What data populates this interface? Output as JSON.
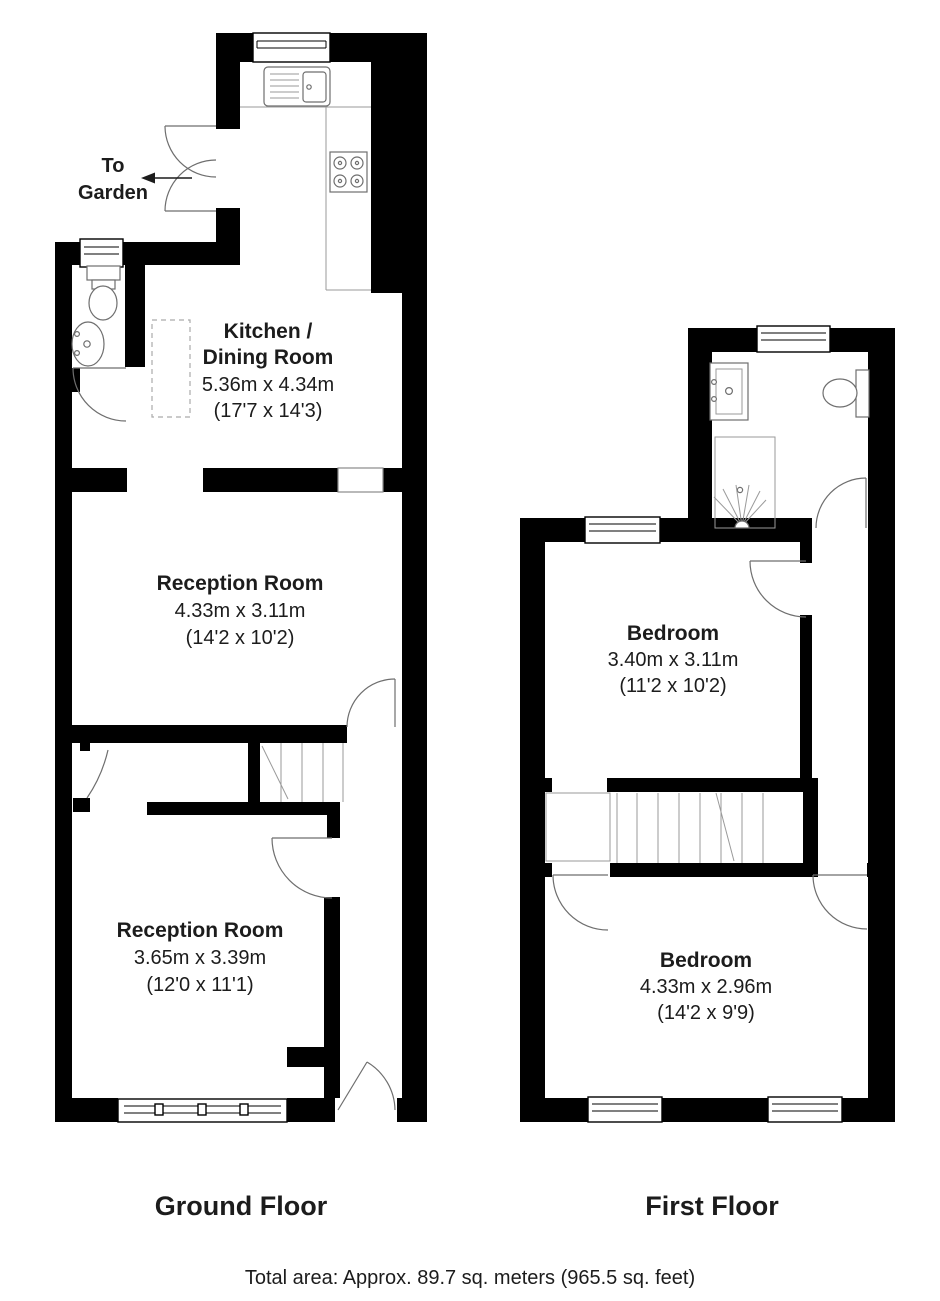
{
  "plan": {
    "ground_floor": {
      "title": "Ground Floor",
      "garden": {
        "line1": "To",
        "line2": "Garden"
      },
      "kitchen": {
        "name1": "Kitchen /",
        "name2": "Dining Room",
        "metric": "5.36m x 4.34m",
        "imperial": "(17'7 x 14'3)"
      },
      "reception1": {
        "name": "Reception Room",
        "metric": "4.33m x 3.11m",
        "imperial": "(14'2 x 10'2)"
      },
      "reception2": {
        "name": "Reception Room",
        "metric": "3.65m x 3.39m",
        "imperial": "(12'0 x 11'1)"
      }
    },
    "first_floor": {
      "title": "First Floor",
      "bedroom1": {
        "name": "Bedroom",
        "metric": "3.40m x 3.11m",
        "imperial": "(11'2 x 10'2)"
      },
      "bedroom2": {
        "name": "Bedroom",
        "metric": "4.33m x 2.96m",
        "imperial": "(14'2 x 9'9)"
      }
    },
    "footer": {
      "total_area": "Total area: Approx. 89.7 sq. meters (965.5 sq. feet)"
    },
    "colors": {
      "wall": "#000000",
      "detail_line": "#6e6e6e",
      "text": "#1c1c1c",
      "background": "#ffffff"
    }
  }
}
